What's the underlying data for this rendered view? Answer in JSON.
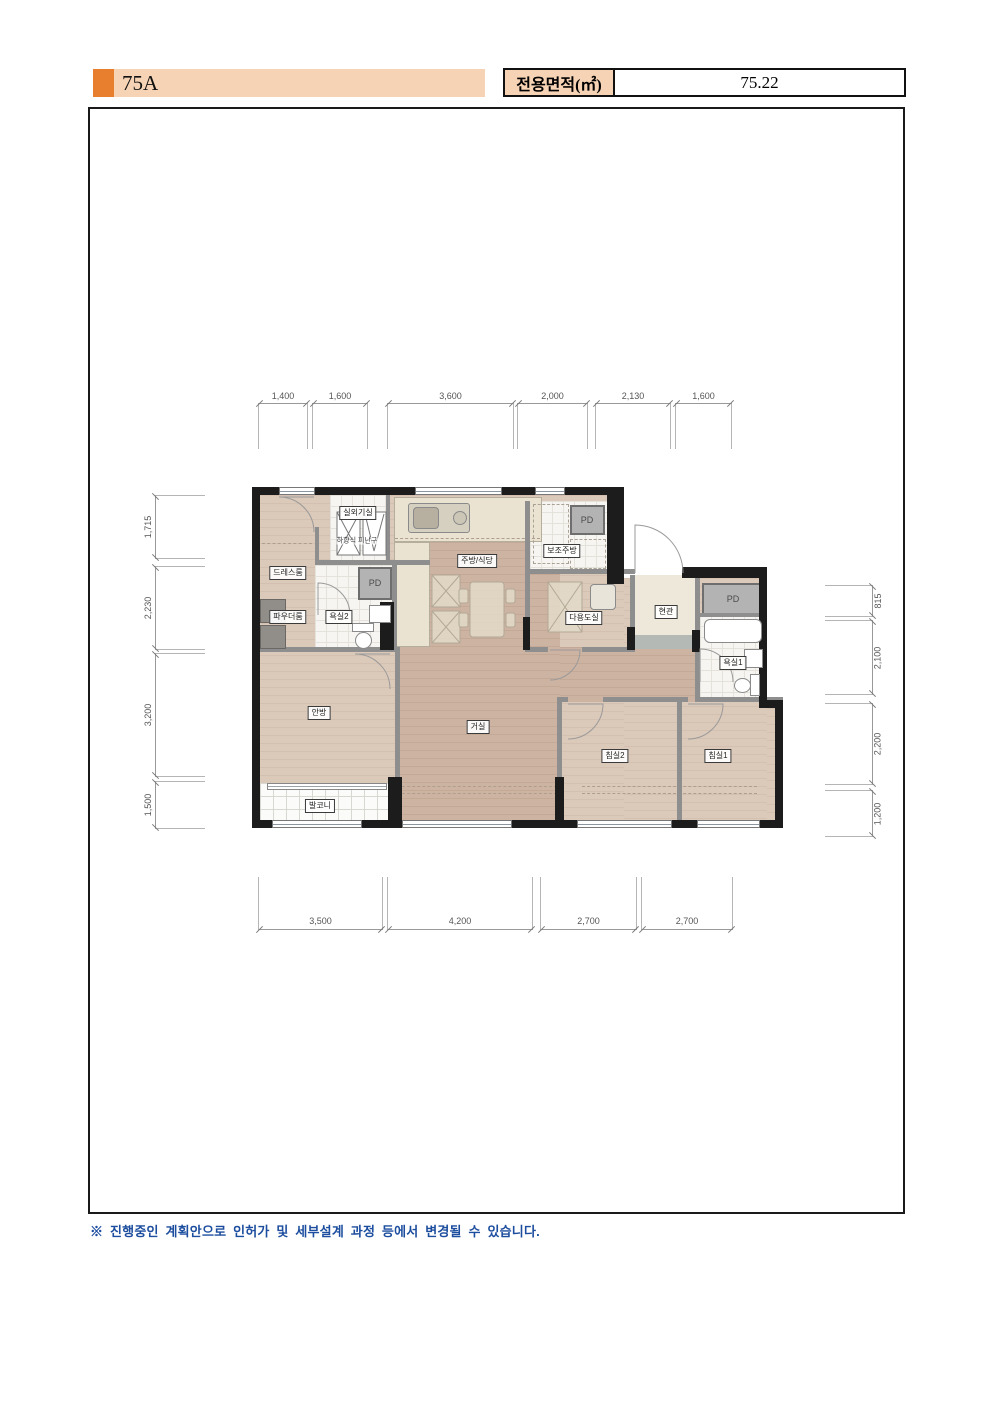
{
  "header": {
    "unit_label": "75A",
    "area_label": "전용면적(㎡)",
    "area_value": "75.22"
  },
  "plan": {
    "pd": "PD",
    "rooms": {
      "outdoor_unit": "실외기실",
      "escape_hatch": "하향식 피난구",
      "dressroom": "드레스룸",
      "powder_room": "파우더룸",
      "bath2": "욕실2",
      "kitchen": "주방/식당",
      "aux_kitchen": "보조주방",
      "utility": "다용도실",
      "entrance": "현관",
      "bath1": "욕실1",
      "master": "안방",
      "living": "거실",
      "bedroom2": "침실2",
      "bedroom1": "침실1",
      "balcony": "발코니"
    }
  },
  "dims": {
    "top": [
      "1,400",
      "1,600",
      "3,600",
      "2,000",
      "2,130",
      "1,600"
    ],
    "left": [
      "1,715",
      "2,230",
      "3,200",
      "1,500"
    ],
    "right": [
      "815",
      "2,100",
      "2,200",
      "1,200"
    ],
    "bottom": [
      "3,500",
      "4,200",
      "2,700",
      "2,700"
    ]
  },
  "footer": {
    "note": "※ 진행중인 계획안으로 인허가 및 세부설계 과정 등에서 변경될 수 있습니다."
  },
  "colors": {
    "accent_orange": "#E87F2F",
    "banner_peach": "#F6D3B4",
    "note_blue": "#1c4d9e",
    "wall_black": "#1c1c1c"
  }
}
